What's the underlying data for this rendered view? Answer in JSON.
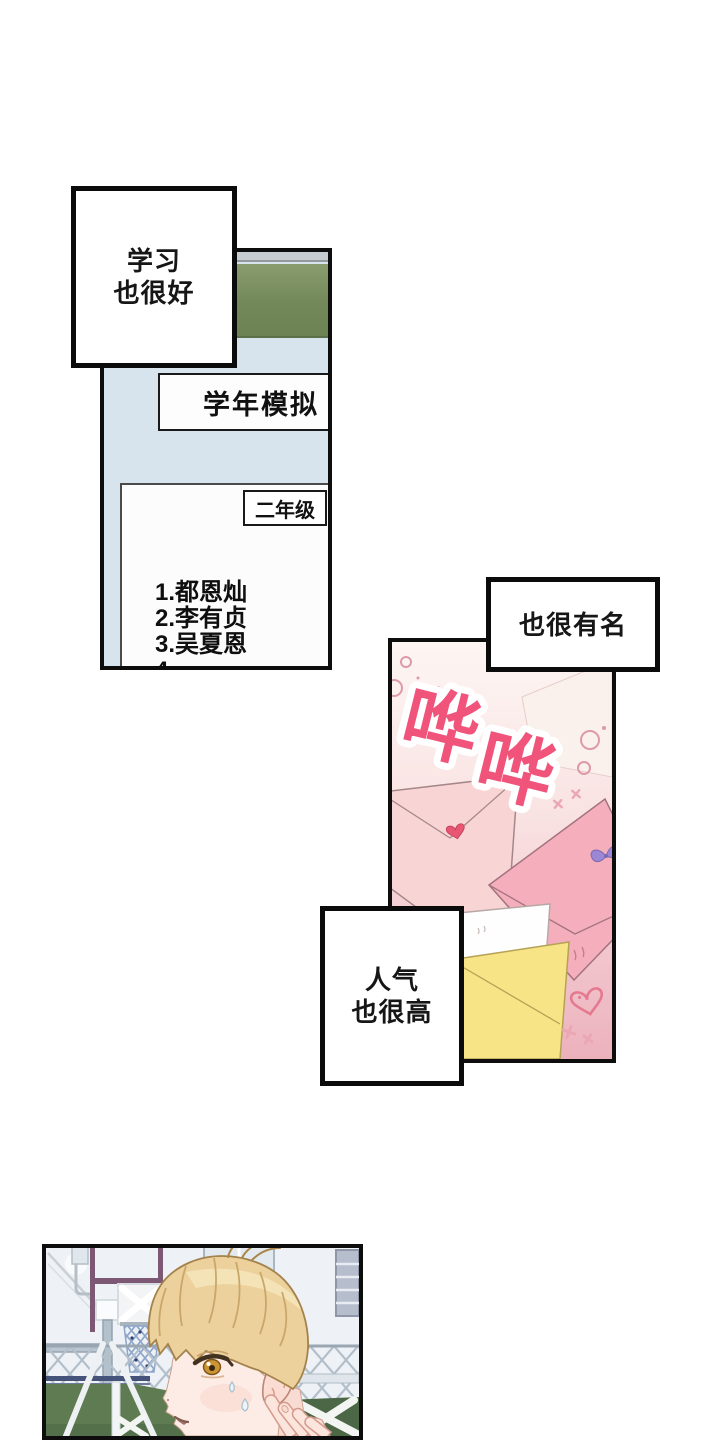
{
  "page": {
    "width": 720,
    "height": 1440,
    "background": "#ffffff",
    "type": "webtoon-comic-page"
  },
  "bubbles": {
    "study": {
      "lines": [
        "学习",
        "也很好"
      ]
    },
    "famous": {
      "lines": [
        "也很有名"
      ]
    },
    "popular": {
      "lines": [
        "人气",
        "也很高"
      ]
    }
  },
  "classroom_panel": {
    "banner": "学年模拟",
    "grade_tag": "二年级",
    "ranking": [
      "1.都恩灿",
      "2.李有贞",
      "3.吴夏恩",
      "4."
    ],
    "colors": {
      "wall": "#d7e4ed",
      "board_green": "#738859",
      "rail_gray": "#c6cccf"
    }
  },
  "letters_panel": {
    "sfx": [
      "哗",
      "哗"
    ],
    "colors": {
      "sfx_pink_top": "#f0547a",
      "sfx_pink_bottom": "#f7a4a0",
      "bg_top": "#fdf6f3",
      "bg_bottom": "#ecb2bc",
      "envelope_light_pink": "#f8d5d4",
      "envelope_pink": "#f5aebc",
      "envelope_white": "#fefefe",
      "envelope_yellow": "#f6e486",
      "heart_seal_red": "#e75672",
      "bow_purple": "#9b87d4",
      "doodle_pink": "#e4798f"
    }
  },
  "court_panel": {
    "colors": {
      "sky": "#eef2f6",
      "field_green": "#5e7b52",
      "goal_green": "#4c6746",
      "hoop_frame_maroon": "#7c5874",
      "fence_gray": "#b3bfca",
      "hair_blonde": "#edd19d",
      "skin": "#fdece5",
      "eye_amber": "#cb9434"
    }
  }
}
